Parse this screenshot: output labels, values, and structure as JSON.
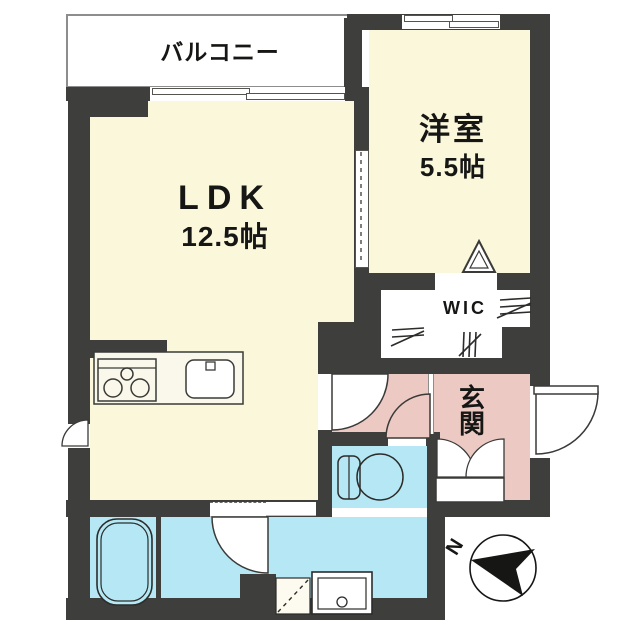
{
  "plan": {
    "type": "apartment-floor-plan",
    "rooms": {
      "balcony": {
        "label": "バルコニー"
      },
      "ldk": {
        "label": "LDK",
        "area": "12.5帖"
      },
      "western_room": {
        "label": "洋室",
        "area": "5.5帖"
      },
      "wic": {
        "label": "WIC"
      },
      "genkan": {
        "label": "玄関"
      }
    },
    "compass": {
      "label": "N"
    },
    "colors": {
      "wall": "#3e3e3c",
      "room_cream": "#faf7db",
      "entry_pink": "#edc9c3",
      "wet_area_blue": "#b5e8f4",
      "background": "#ffffff"
    }
  }
}
